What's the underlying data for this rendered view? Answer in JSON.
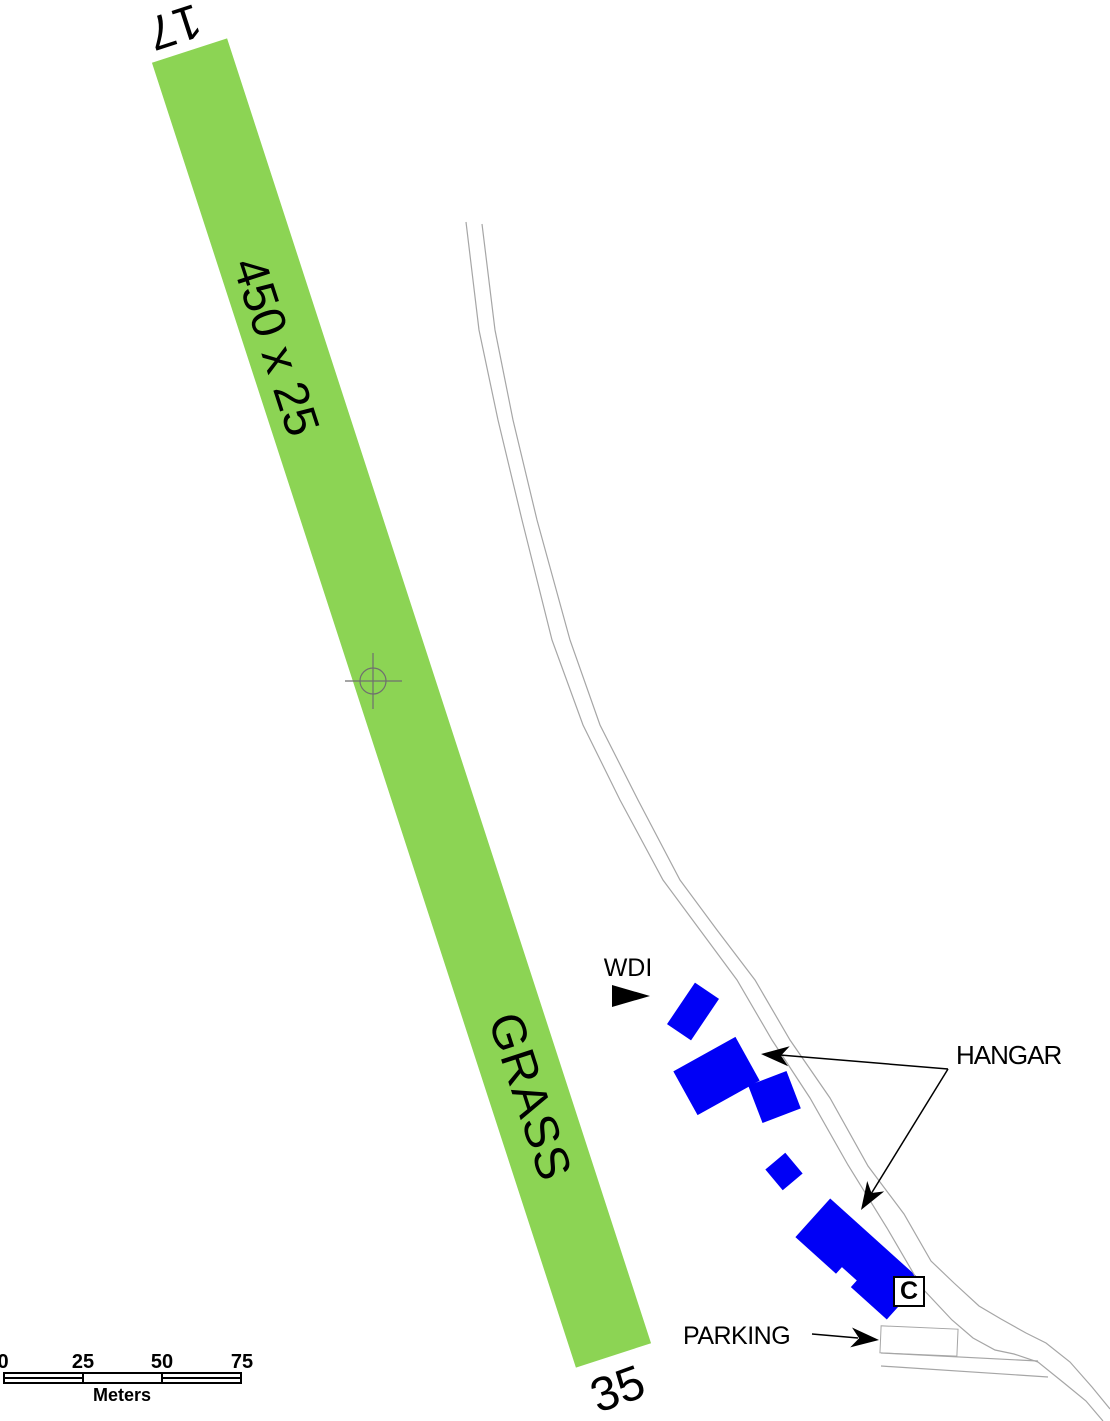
{
  "colors": {
    "runway_green": "#8CD454",
    "building_blue": "#0000F6",
    "road_gray": "#A6A6A6",
    "marker_gray": "#6F6F6F",
    "ink": "#000000"
  },
  "runway": {
    "number_17": "17",
    "number_35": "35",
    "dimensions": "450 x 25",
    "surface": "GRASS"
  },
  "labels": {
    "wdi": "WDI",
    "hangar": "HANGAR",
    "parking": "PARKING",
    "c_badge": "C"
  },
  "scale_bar": {
    "ticks": [
      "0",
      "25",
      "50",
      "75"
    ],
    "units": "Meters"
  }
}
